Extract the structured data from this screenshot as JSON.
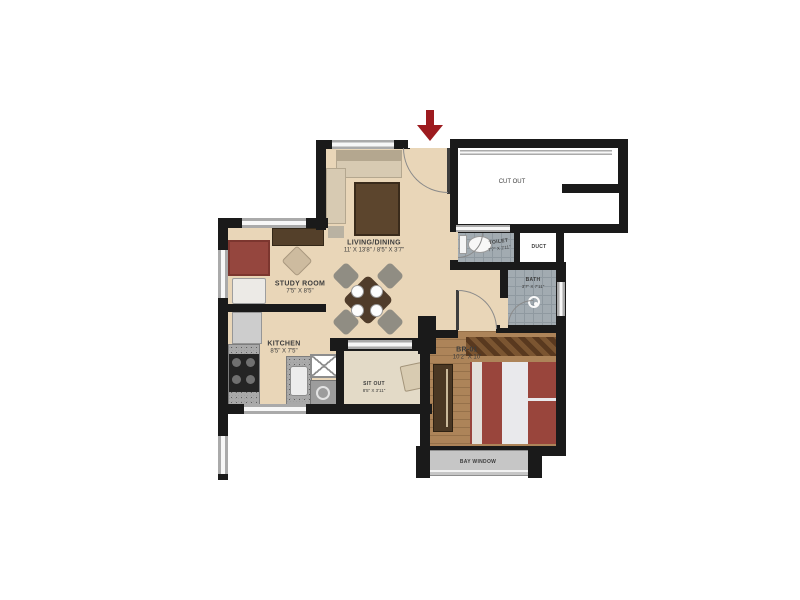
{
  "rooms": {
    "living": {
      "name": "LIVING/DINING",
      "dims": "11' X 13'8\" / 8'5\" X 3'7\""
    },
    "study": {
      "name": "STUDY ROOM",
      "dims": "7'5\" X 8'5\""
    },
    "kitchen": {
      "name": "KITCHEN",
      "dims": "8'5\" X 7'5\""
    },
    "toilet": {
      "name": "TOILET",
      "dims": "7'7\" X 2'11\""
    },
    "duct": {
      "name": "DUCT"
    },
    "bath": {
      "name": "BATH",
      "dims": "3'7\" X 7'11\""
    },
    "bedroom": {
      "name": "BR-01",
      "dims": "10'2\" X 10'"
    },
    "sitout": {
      "name": "SIT OUT",
      "dims": "8'5\" X 3'11\""
    },
    "cutout": {
      "name": "CUT OUT"
    },
    "baywindow": {
      "name": "BAY WINDOW"
    }
  },
  "colors": {
    "wall": "#1a1a1a",
    "floor_beige": "#e9d6b8",
    "wood_floor": "#ad8459",
    "tile_gray": "#a2abb1",
    "bed_maroon": "#99453c",
    "entry_arrow_red": "#9d1b1f"
  }
}
